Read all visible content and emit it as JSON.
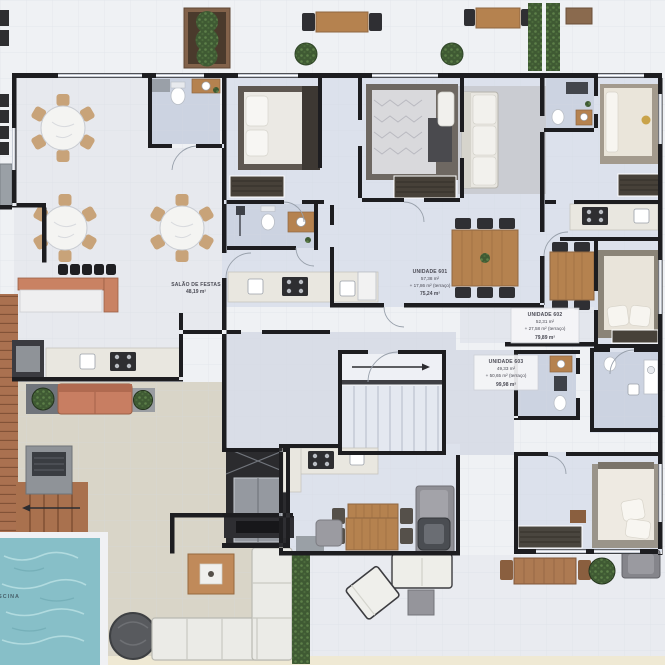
{
  "plan": {
    "party_room": {
      "name": "SALÃO DE FESTAS",
      "area": "48,19 m²"
    },
    "pool_label": "PISCINA",
    "units": [
      {
        "name": "UNIDADE 601",
        "private_area": "57,38 m²",
        "terrace_area": "+ 17,86 m² (terraço)",
        "total_area": "75,24 m²"
      },
      {
        "name": "UNIDADE 602",
        "private_area": "52,31 m²",
        "terrace_area": "+ 27,58 m² (terraço)",
        "total_area": "79,89 m²"
      },
      {
        "name": "UNIDADE 603",
        "private_area": "49,33 m²",
        "terrace_area": "+ 50,65 m² (terraço)",
        "total_area": "99,98 m²"
      }
    ],
    "colors": {
      "wall": "#1d1d20",
      "interior_floor": "#dce1ec",
      "bathroom_floor": "#ccd3e1",
      "party_floor": "#e7e9ee",
      "terrace_floor": "#d9d5c8",
      "pool_water": "#87bfc8",
      "deck_wood": "#aa7150",
      "hedge_green": "#3f5a33",
      "wood_furniture": "#b5824f",
      "sofa_salmon": "#c87e62"
    }
  }
}
